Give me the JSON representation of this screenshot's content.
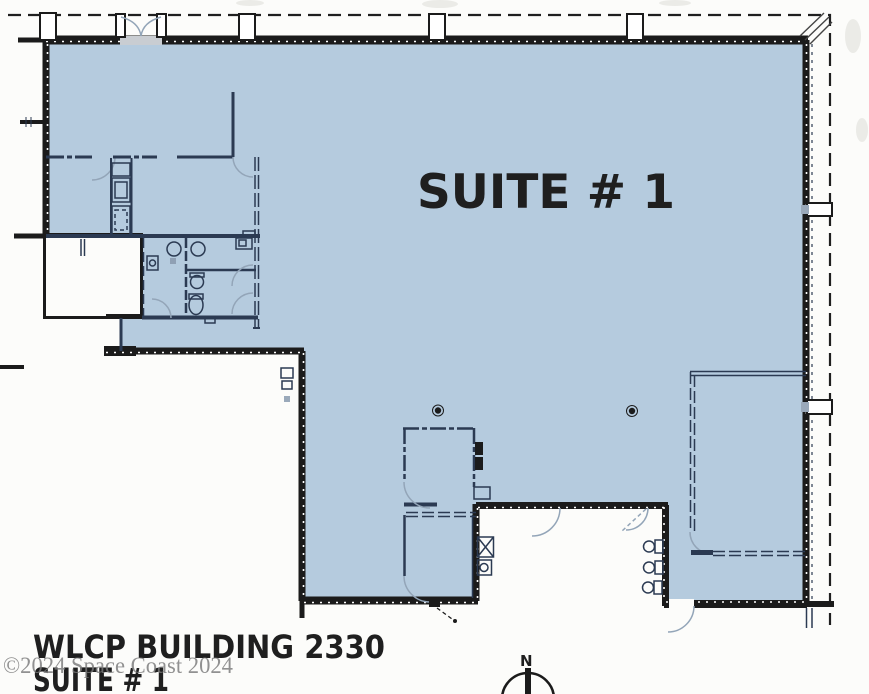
{
  "plan": {
    "suite_label": "SUITE # 1"
  },
  "title_block": {
    "building_line": "WLCP BUILDING 2330",
    "suite_line": "SUITE # 1"
  },
  "watermark": {
    "text": "©2024 Space Coast 2024"
  },
  "compass": {
    "north_label": "N"
  },
  "colors": {
    "suite_fill": "#b5cbde",
    "wall": "#1b1b1b",
    "thin_wall": "#2b3a52",
    "door_arc": "#93a5b8",
    "watermark_ink": "#7a7a7a",
    "ink": "#1f1f1f",
    "paper": "#fcfcfa"
  }
}
